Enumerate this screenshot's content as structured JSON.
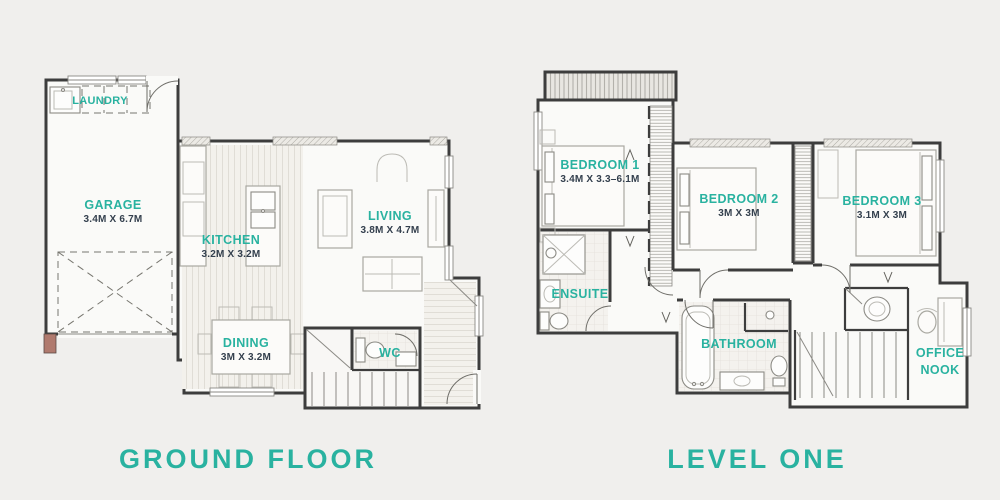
{
  "palette": {
    "accent_teal": "#29b2a0",
    "dimension_text": "#333f4d",
    "wall": "#3d3d3d",
    "background": "#f0efed"
  },
  "ground_floor": {
    "title": "GROUND FLOOR",
    "labels": {
      "laundry": {
        "name": "LAUNDRY"
      },
      "garage": {
        "name": "GARAGE",
        "dims": "3.4M X 6.7M"
      },
      "kitchen": {
        "name": "KITCHEN",
        "dims": "3.2M X 3.2M"
      },
      "living": {
        "name": "LIVING",
        "dims": "3.8M X 4.7M"
      },
      "dining": {
        "name": "DINING",
        "dims": "3M X 3.2M"
      },
      "wc": {
        "name": "WC"
      }
    }
  },
  "level_one": {
    "title": "LEVEL ONE",
    "labels": {
      "bedroom1": {
        "name": "BEDROOM 1",
        "dims": "3.4M X 3.3–6.1M"
      },
      "bedroom2": {
        "name": "BEDROOM 2",
        "dims": "3M X 3M"
      },
      "bedroom3": {
        "name": "BEDROOM 3",
        "dims": "3.1M X 3M"
      },
      "ensuite": {
        "name": "ENSUITE"
      },
      "bathroom": {
        "name": "BATHROOM"
      },
      "office_nook": {
        "line1": "OFFICE",
        "line2": "NOOK"
      }
    }
  }
}
